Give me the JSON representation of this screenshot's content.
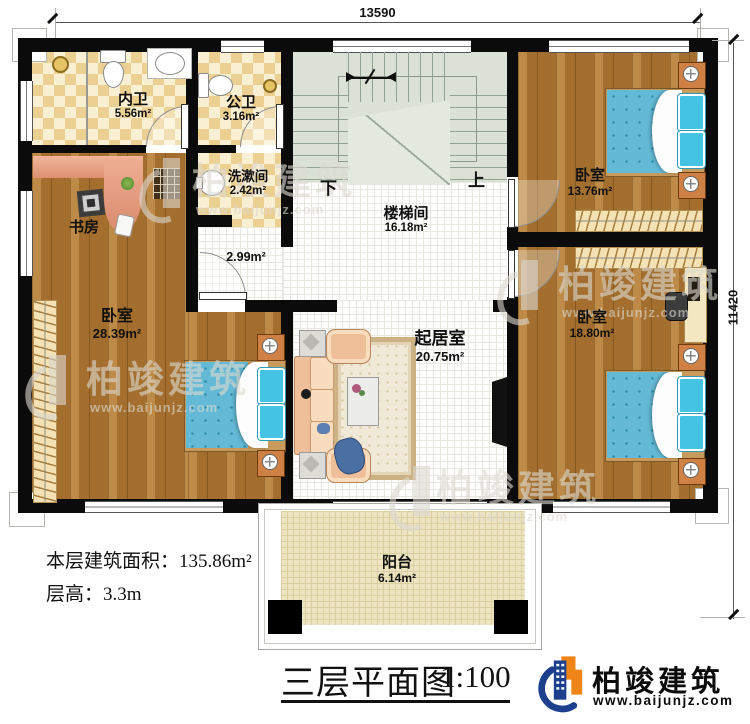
{
  "dimensions": {
    "top": "13590",
    "right": "11420"
  },
  "rooms": {
    "neiwei": {
      "name": "内卫",
      "area": "5.56m²"
    },
    "gongwei": {
      "name": "公卫",
      "area": "3.16m²"
    },
    "xishujian": {
      "name": "洗漱间",
      "area": "2.42m²"
    },
    "shufang": {
      "name": "书房"
    },
    "bedroom_left": {
      "name": "卧室",
      "area": "28.39m²"
    },
    "stairwell": {
      "name": "楼梯间",
      "area": "16.18m²"
    },
    "living": {
      "name": "起居室",
      "area": "20.75m²"
    },
    "bedroom_top_right": {
      "name": "卧室",
      "area": "13.76m²"
    },
    "bedroom_bottom_right": {
      "name": "卧室",
      "area": "18.80m²"
    },
    "balcony": {
      "name": "阳台",
      "area": "6.14m²"
    }
  },
  "hall_area": "2.99m²",
  "stairs": {
    "up": "上",
    "down": "下"
  },
  "notes": {
    "floor_area": "本层建筑面积：135.86m²",
    "floor_height": "层高：3.3m"
  },
  "title": {
    "text": "三层平面图",
    "scale": "1:100"
  },
  "brand": {
    "name": "柏竣建筑",
    "website": "www.baijunjz.com"
  },
  "watermark": {
    "name": "柏竣建筑",
    "website": "www.baijunjz.com"
  }
}
